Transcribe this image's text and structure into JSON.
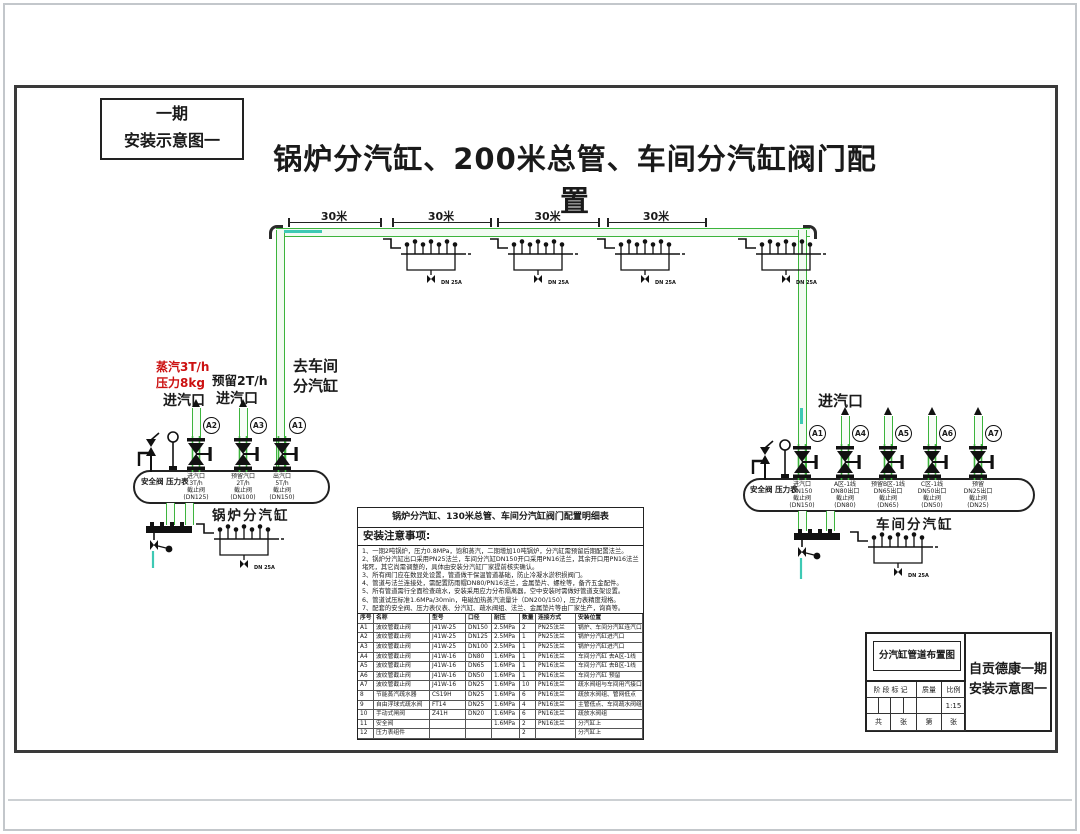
{
  "page": {
    "stage_box": {
      "line1": "一期",
      "line2": "安装示意图一"
    },
    "main_title": "锅炉分汽缸、200米总管、车间分汽缸阀门配置"
  },
  "pipe": {
    "dimension_labels": [
      "30米",
      "30米",
      "30米",
      "30米"
    ],
    "trap_label": "DN 25A"
  },
  "left": {
    "steam_rate_red": "蒸汽3T/h",
    "pressure_red": "压力8kg",
    "inlet1": "进汽口",
    "reserve": "预留2T/h",
    "inlet2": "进汽口",
    "to_workshop1": "去车间",
    "to_workshop2": "分汽缸",
    "safety_and_gauge": "安全阀  压力表",
    "cylinder": "锅炉分汽缸",
    "valves": [
      {
        "tag": "A2",
        "lines": [
          "进汽口",
          "3T/h",
          "截止阀",
          "(DN125)"
        ]
      },
      {
        "tag": "A3",
        "lines": [
          "预留汽口",
          "2T/h",
          "截止阀",
          "(DN100)"
        ]
      },
      {
        "tag": "A1",
        "lines": [
          "出汽口",
          "5T/h",
          "截止阀",
          "(DN150)"
        ]
      }
    ]
  },
  "right": {
    "inlet": "进汽口",
    "safety_and_gauge": "安全阀  压力表",
    "cylinder": "车间分汽缸",
    "valves": [
      {
        "tag": "A1",
        "lines": [
          "进汽口",
          "DN150",
          "截止阀",
          "(DN150)"
        ]
      },
      {
        "tag": "A4",
        "lines": [
          "A区-1线",
          "DN80出口",
          "截止阀",
          "(DN80)"
        ]
      },
      {
        "tag": "A5",
        "lines": [
          "预留B区-1线",
          "DN65出口",
          "截止阀",
          "(DN65)"
        ]
      },
      {
        "tag": "A6",
        "lines": [
          "C区-1线",
          "DN50出口",
          "截止阀",
          "(DN50)"
        ]
      },
      {
        "tag": "A7",
        "lines": [
          "预留",
          "DN25出口",
          "截止阀",
          "(DN25)"
        ]
      }
    ]
  },
  "spec": {
    "title": "锅炉分汽缸、130米总管、车间分汽缸阀门配置明细表",
    "notes_title": "安装注意事项:",
    "notes": [
      "1、一期2吨锅炉，压力0.8MPa，饱和蒸汽，二期增加10吨锅炉，分汽缸需预留后期配置法兰。",
      "2、锅炉分汽缸出口采用PN25法兰，车间分汽缸DN150开口采用PN16法兰，其余开口用PN16法兰堵死，其它尚需调整的，具体由安装分汽缸厂家提前核实确认。",
      "3、所有阀门应在数显处设置，管道做干保温管道基础，防止冷凝水淤积损阀门。",
      "4、管道与法兰连接处，需配置防雨帽DN80/PN16法兰，金属垫片、螺栓等，备齐五金配件。",
      "5、所有管道需行全面检查疏水，安装采用应力分布隔离器，空中安装时需做好管道支架设置。",
      "6、管道试压标准1.6MPa/30min，电磁加热蒸汽流量计（DN200/150），压力表精度规格。",
      "7、配套的安全阀、压力表仪表、分汽缸、疏水阀组、法兰、金属垫片等由厂家生产，询商等。"
    ],
    "headers": [
      "序号",
      "名称",
      "型号",
      "口径",
      "耐压",
      "数量",
      "连接方式",
      "安装位置"
    ],
    "rows": [
      [
        "A1",
        "波纹管截止阀",
        "J41W-25",
        "DN150",
        "2.5MPa",
        "2",
        "PN25法兰",
        "锅炉、车间分汽缸连汽口"
      ],
      [
        "A2",
        "波纹管截止阀",
        "J41W-25",
        "DN125",
        "2.5MPa",
        "1",
        "PN25法兰",
        "锅炉分汽缸进汽口"
      ],
      [
        "A3",
        "波纹管截止阀",
        "J41W-25",
        "DN100",
        "2.5MPa",
        "1",
        "PN25法兰",
        "锅炉分汽缸进汽口"
      ],
      [
        "A4",
        "波纹管截止阀",
        "J41W-16",
        "DN80",
        "1.6MPa",
        "1",
        "PN16法兰",
        "车间分汽缸 去A区-1线"
      ],
      [
        "A5",
        "波纹管截止阀",
        "J41W-16",
        "DN65",
        "1.6MPa",
        "1",
        "PN16法兰",
        "车间分汽缸 去B区-1线"
      ],
      [
        "A6",
        "波纹管截止阀",
        "J41W-16",
        "DN50",
        "1.6MPa",
        "1",
        "PN16法兰",
        "车间分汽缸 预留"
      ],
      [
        "A7",
        "波纹管截止阀",
        "J41W-16",
        "DN25",
        "1.6MPa",
        "10",
        "PN16法兰",
        "疏水阀组与车间用汽接口"
      ],
      [
        "8",
        "节能蒸汽疏水器",
        "CS19H",
        "DN25",
        "1.6MPa",
        "6",
        "PN16法兰",
        "疏放水阀组、管网低点"
      ],
      [
        "9",
        "自由浮球式疏水阀",
        "FT14",
        "DN25",
        "1.6MPa",
        "4",
        "PN16法兰",
        "主管低点、车间疏水阀组"
      ],
      [
        "10",
        "手动式闸阀",
        "Z41H",
        "DN20",
        "1.6MPa",
        "6",
        "PN16法兰",
        "疏放水阀组"
      ],
      [
        "11",
        "安全阀",
        "",
        "",
        "1.6MPa",
        "2",
        "PN16法兰",
        "分汽缸上"
      ],
      [
        "12",
        "压力表组件",
        "",
        "",
        "",
        "2",
        "",
        "分汽缸上"
      ]
    ]
  },
  "title_block": {
    "drawing_name": "分汽缸管道布置图",
    "stage_mark": "阶段标记",
    "quality": "质量",
    "scale_label": "比例",
    "scale_value": "1:15",
    "sheet_cells": [
      "共",
      "张",
      "第",
      "张"
    ],
    "project1": "自贡德康一期",
    "project2": "安装示意图一"
  },
  "colors": {
    "pipe_green": "#3cb43c",
    "annotation_red": "#cc1111",
    "condensate_teal": "#3ec9b4"
  }
}
